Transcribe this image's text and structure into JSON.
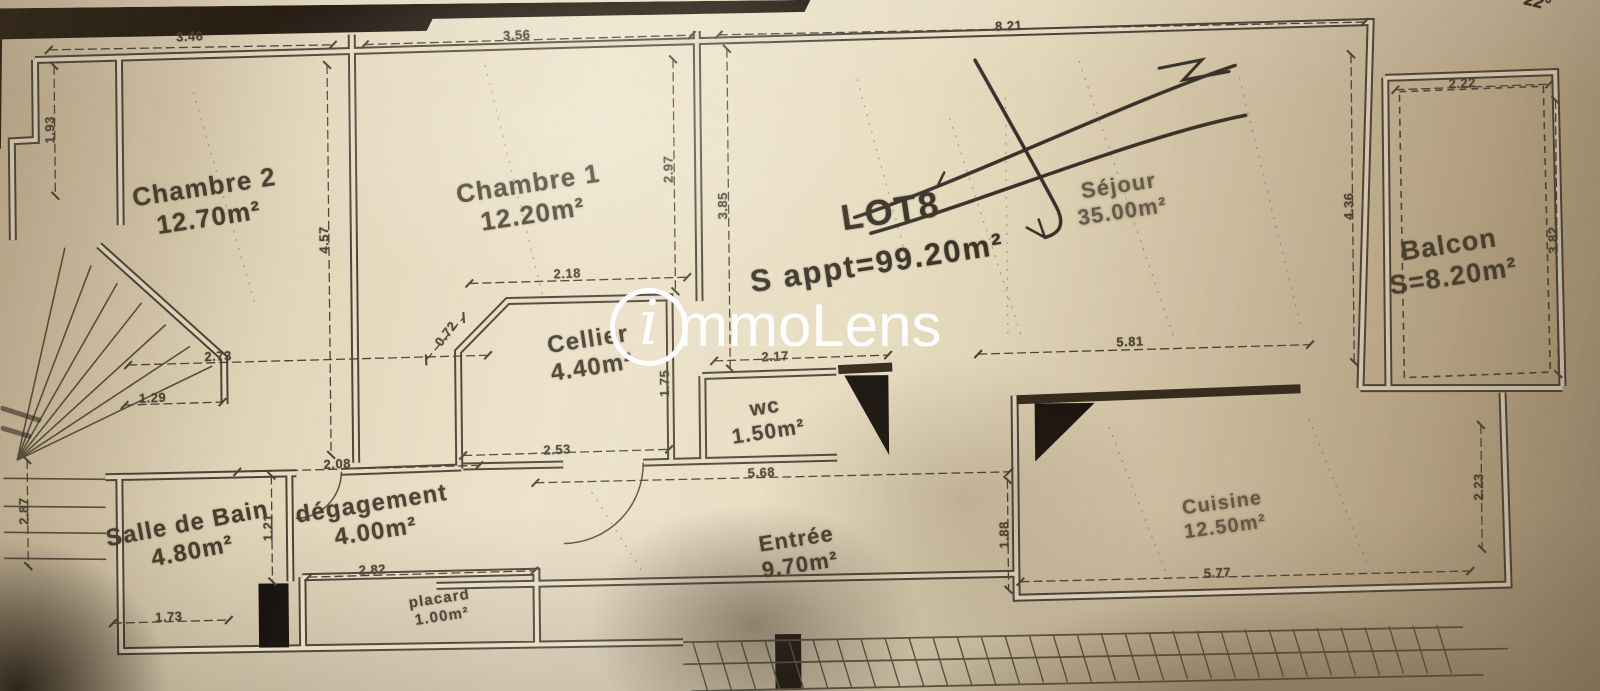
{
  "brand": {
    "watermark_initial": "i",
    "watermark_text": "mmoLens"
  },
  "lot": {
    "label": "LOT8",
    "surface": "S appt=99.20m²"
  },
  "handwriting": {
    "corner_note": "22°"
  },
  "rooms": [
    {
      "name": "Chambre 2",
      "area": "12.70m²"
    },
    {
      "name": "Chambre 1",
      "area": "12.20m²"
    },
    {
      "name": "Cellier",
      "area": "4.40m²"
    },
    {
      "name": "Séjour",
      "area": "35.00m²"
    },
    {
      "name": "Balcon",
      "area": "S=8.20m²"
    },
    {
      "name": "wc",
      "area": "1.50m²"
    },
    {
      "name": "Salle de Bain",
      "area": "4.80m²"
    },
    {
      "name": "dégagement",
      "area": "4.00m²"
    },
    {
      "name": "placard",
      "area": "1.00m²"
    },
    {
      "name": "Entrée",
      "area": "9.70m²"
    },
    {
      "name": "Cuisine",
      "area": "12.50m²"
    }
  ],
  "dims": [
    "3.46",
    "3.56",
    "8.21",
    "2.22",
    "1.93",
    "4.57",
    "2.97",
    "3.85",
    "2.18",
    "0.72",
    "2.73",
    "1.29",
    "2.53",
    "1.75",
    "2.17",
    "2.08",
    "5.68",
    "5.81",
    "4.36",
    "3.82",
    "2.87",
    "1.21",
    "2.82",
    "1.73",
    "5.77",
    "1.88",
    "2.23"
  ]
}
